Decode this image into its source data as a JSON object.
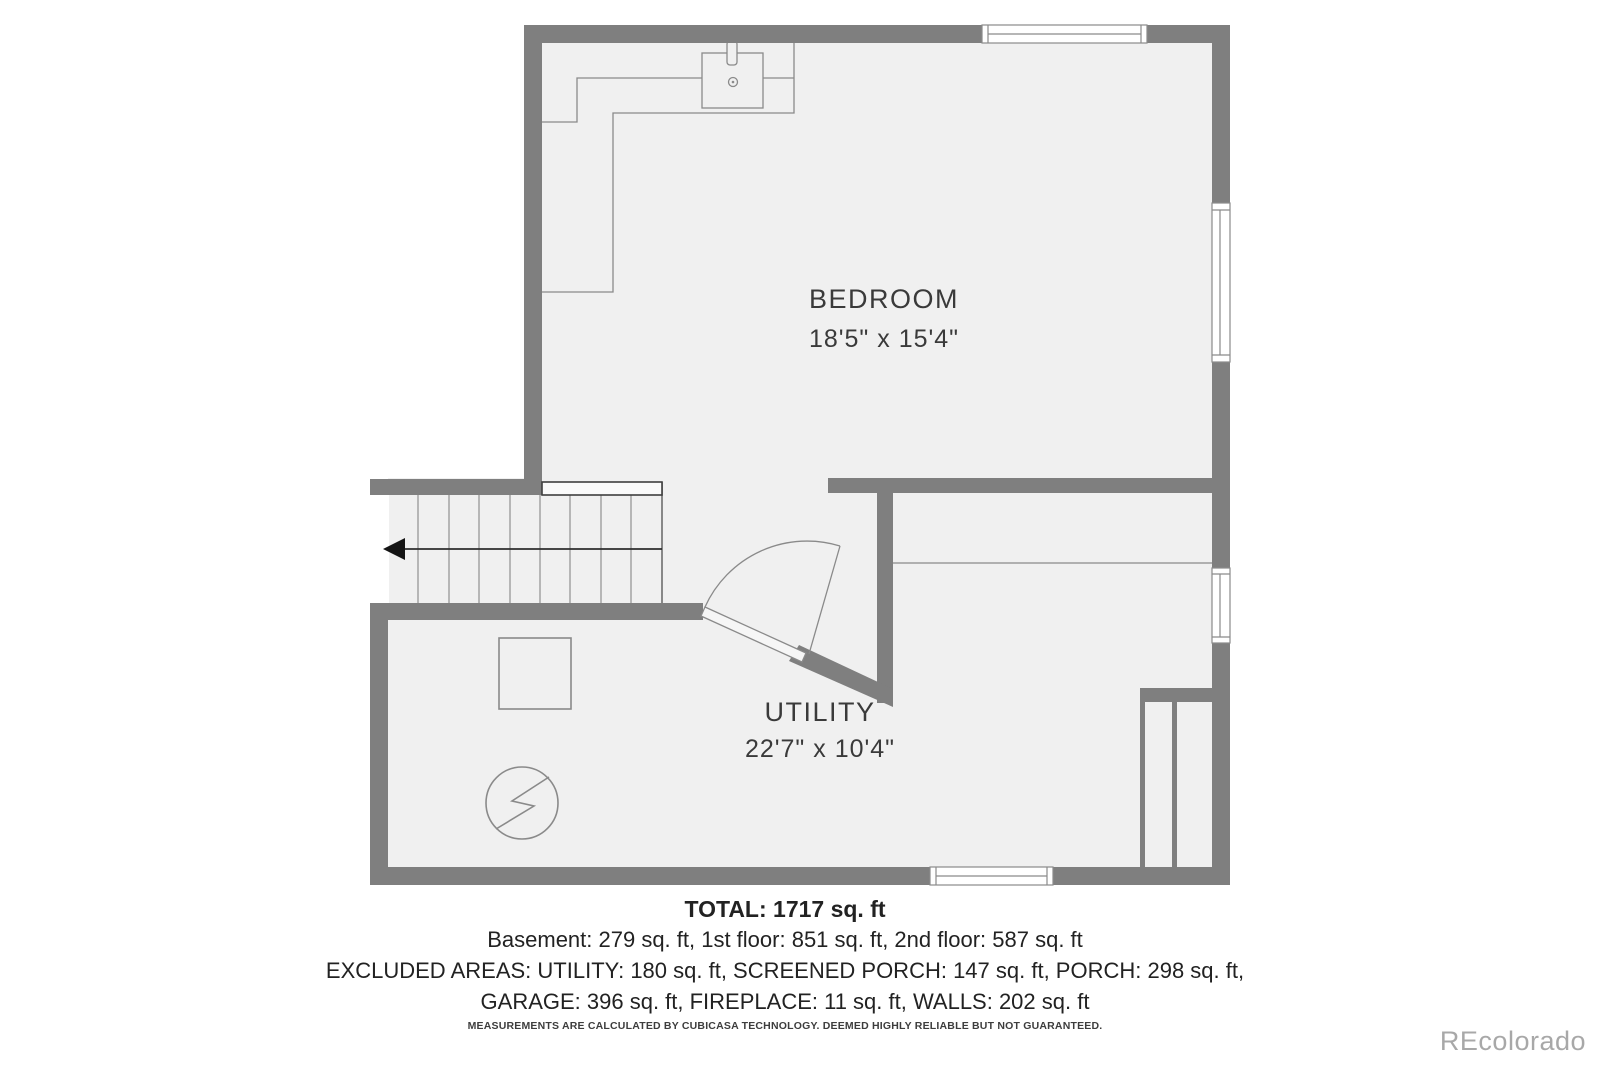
{
  "floor_plan": {
    "rooms": [
      {
        "name": "BEDROOM",
        "dimensions": "18'5\" x 15'4\""
      },
      {
        "name": "UTILITY",
        "dimensions": "22'7\" x 10'4\""
      }
    ]
  },
  "summary": {
    "total": "TOTAL: 1717 sq. ft",
    "floors": "Basement: 279 sq. ft, 1st floor: 851 sq. ft, 2nd floor: 587 sq. ft",
    "excluded_1": "EXCLUDED AREAS: UTILITY: 180 sq. ft, SCREENED PORCH: 147 sq. ft, PORCH: 298 sq. ft,",
    "excluded_2": "GARAGE: 396 sq. ft, FIREPLACE: 11 sq. ft, WALLS: 202 sq. ft",
    "disclaimer": "MEASUREMENTS ARE CALCULATED BY CUBICASA TECHNOLOGY. DEEMED HIGHLY RELIABLE BUT NOT GUARANTEED."
  },
  "watermark": "REcolorado",
  "colors": {
    "wall": "#7f7f7f",
    "floor": "#f0f0f0",
    "outline": "#8a8a8a",
    "label_text": "#3a3a3a",
    "summary_text": "#222222",
    "watermark_text": "#a8a8a8",
    "background": "#ffffff"
  }
}
